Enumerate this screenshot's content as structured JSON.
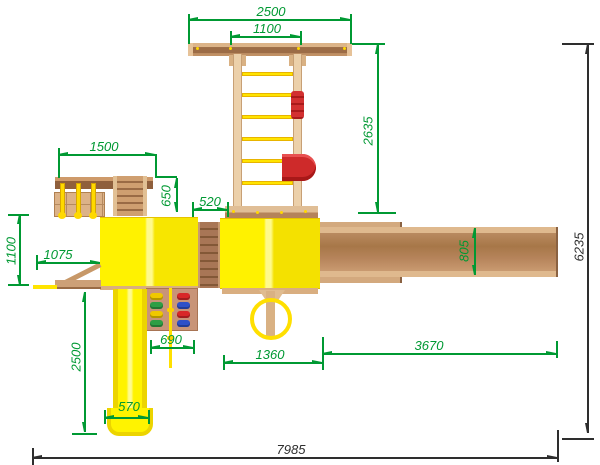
{
  "drawing": {
    "description": "Top-view technical drawing of a children's playground complex with dimensions",
    "units_implied": "mm",
    "dimension_colors": {
      "detail": "#009933",
      "overall": "#2e2e2e"
    },
    "component_colors": {
      "roof_yellow": "#fff200",
      "slide_yellow": "#fff300",
      "chain_yellow": "#ffd900",
      "wood_light": "#e9cba4",
      "wood_medium": "#c08a5e",
      "wood_dark": "#9a6a44",
      "accent_red": "#d22f2f",
      "hold_yellow": "#f0c800",
      "hold_green": "#2e9e44",
      "hold_red": "#d82828",
      "hold_blue": "#2e50c8"
    },
    "dimensions": {
      "crossbar_length": "2500",
      "crossbar_inner": "1100",
      "gym_ladder_length": "2635",
      "swing_section_width": "1500",
      "swing_to_tower": "650",
      "bridge_width": "520",
      "ramp_beam_width": "805",
      "overall_depth": "6235",
      "left_depth": "1100",
      "balcony_width": "1075",
      "slide_run": "2500",
      "climb_wall_width": "690",
      "slide_width": "570",
      "tower_width": "1360",
      "ramp_beam_length": "3670",
      "overall_width": "7985"
    }
  }
}
